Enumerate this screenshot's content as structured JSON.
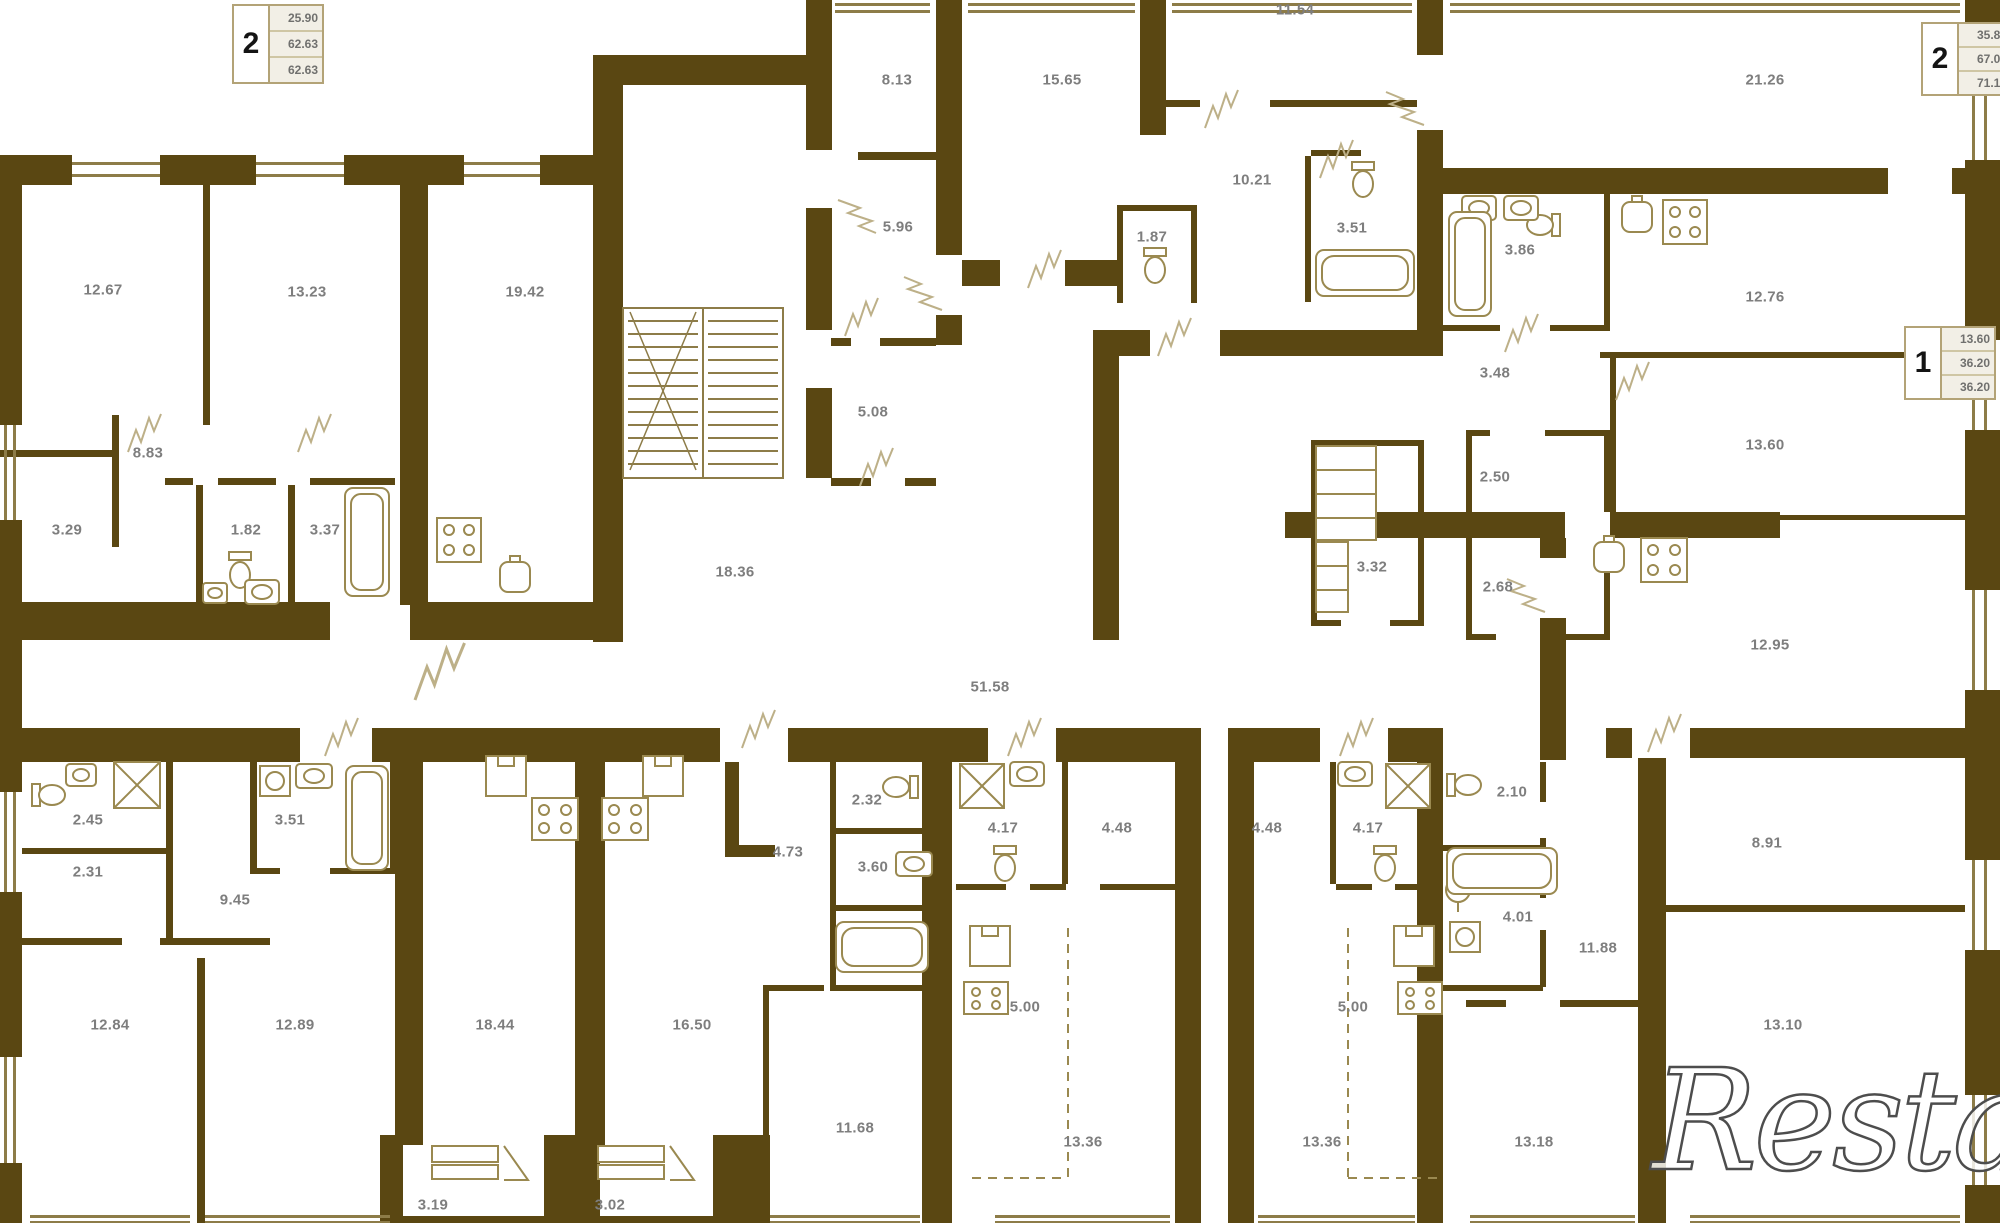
{
  "plan": {
    "title": "apartment-floor-plan",
    "watermark": "Restate",
    "colors": {
      "wall": "#5a4712",
      "thin_wall": "#8d7c48",
      "fixture": "#9a8950",
      "door": "#bdb088",
      "label_text": "#7e7e7e",
      "box_border": "#b3a377"
    },
    "unit_summaries": [
      {
        "rooms": "2",
        "values": [
          "25.90",
          "62.63",
          "62.63"
        ],
        "x": 232,
        "y": 4
      },
      {
        "rooms": "2",
        "values": [
          "35.80",
          "67.04",
          "71.15"
        ],
        "x": 1921,
        "y": 22
      },
      {
        "rooms": "1",
        "values": [
          "13.60",
          "36.20",
          "36.20"
        ],
        "x": 1904,
        "y": 326
      }
    ],
    "room_labels": [
      {
        "v": "8.13",
        "x": 897,
        "y": 80
      },
      {
        "v": "15.65",
        "x": 1062,
        "y": 80
      },
      {
        "v": "11.54",
        "x": 1295,
        "y": 10
      },
      {
        "v": "21.26",
        "x": 1765,
        "y": 80
      },
      {
        "v": "12.67",
        "x": 103,
        "y": 290
      },
      {
        "v": "13.23",
        "x": 307,
        "y": 292
      },
      {
        "v": "19.42",
        "x": 525,
        "y": 292
      },
      {
        "v": "5.96",
        "x": 898,
        "y": 227
      },
      {
        "v": "1.87",
        "x": 1152,
        "y": 237
      },
      {
        "v": "10.21",
        "x": 1252,
        "y": 180
      },
      {
        "v": "3.51",
        "x": 1352,
        "y": 228
      },
      {
        "v": "3.86",
        "x": 1520,
        "y": 250
      },
      {
        "v": "12.76",
        "x": 1765,
        "y": 297
      },
      {
        "v": "3.48",
        "x": 1495,
        "y": 373
      },
      {
        "v": "13.60",
        "x": 1765,
        "y": 445
      },
      {
        "v": "2.50",
        "x": 1495,
        "y": 477
      },
      {
        "v": "8.83",
        "x": 148,
        "y": 453
      },
      {
        "v": "3.29",
        "x": 67,
        "y": 530
      },
      {
        "v": "1.82",
        "x": 246,
        "y": 530
      },
      {
        "v": "3.37",
        "x": 325,
        "y": 530
      },
      {
        "v": "5.08",
        "x": 873,
        "y": 412
      },
      {
        "v": "18.36",
        "x": 735,
        "y": 572
      },
      {
        "v": "3.32",
        "x": 1372,
        "y": 567
      },
      {
        "v": "2.68",
        "x": 1498,
        "y": 587
      },
      {
        "v": "12.95",
        "x": 1770,
        "y": 645
      },
      {
        "v": "51.58",
        "x": 990,
        "y": 687
      },
      {
        "v": "2.45",
        "x": 88,
        "y": 820
      },
      {
        "v": "2.31",
        "x": 88,
        "y": 872
      },
      {
        "v": "3.51",
        "x": 290,
        "y": 820
      },
      {
        "v": "9.45",
        "x": 235,
        "y": 900
      },
      {
        "v": "2.32",
        "x": 867,
        "y": 800
      },
      {
        "v": "4.73",
        "x": 788,
        "y": 852
      },
      {
        "v": "3.60",
        "x": 873,
        "y": 867
      },
      {
        "v": "4.17",
        "x": 1003,
        "y": 828
      },
      {
        "v": "4.48",
        "x": 1117,
        "y": 828
      },
      {
        "v": "4.48",
        "x": 1267,
        "y": 828
      },
      {
        "v": "4.17",
        "x": 1368,
        "y": 828
      },
      {
        "v": "2.10",
        "x": 1512,
        "y": 792
      },
      {
        "v": "4.01",
        "x": 1518,
        "y": 917
      },
      {
        "v": "11.88",
        "x": 1598,
        "y": 948
      },
      {
        "v": "8.91",
        "x": 1767,
        "y": 843
      },
      {
        "v": "5.00",
        "x": 1025,
        "y": 1007
      },
      {
        "v": "5.00",
        "x": 1353,
        "y": 1007
      },
      {
        "v": "12.84",
        "x": 110,
        "y": 1025
      },
      {
        "v": "12.89",
        "x": 295,
        "y": 1025
      },
      {
        "v": "18.44",
        "x": 495,
        "y": 1025
      },
      {
        "v": "16.50",
        "x": 692,
        "y": 1025
      },
      {
        "v": "13.10",
        "x": 1783,
        "y": 1025
      },
      {
        "v": "11.68",
        "x": 855,
        "y": 1128
      },
      {
        "v": "13.36",
        "x": 1083,
        "y": 1142
      },
      {
        "v": "13.36",
        "x": 1322,
        "y": 1142
      },
      {
        "v": "13.18",
        "x": 1534,
        "y": 1142
      },
      {
        "v": "3.19",
        "x": 433,
        "y": 1205
      },
      {
        "v": "3.02",
        "x": 610,
        "y": 1205
      }
    ]
  }
}
